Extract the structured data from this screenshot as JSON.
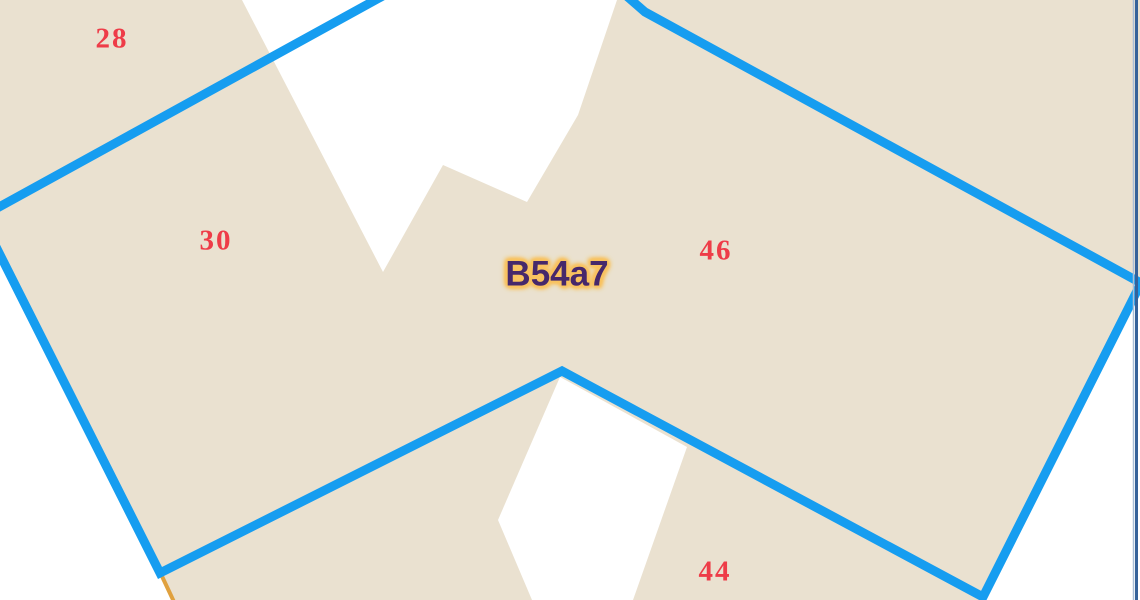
{
  "map": {
    "region_label": {
      "text": "B54a7",
      "x": 557,
      "y": 274,
      "color": "#46286b",
      "glow_color": "#f9c360"
    },
    "parcel_numbers": [
      {
        "text": "28",
        "x": 112,
        "y": 39
      },
      {
        "text": "30",
        "x": 216,
        "y": 241
      },
      {
        "text": "46",
        "x": 716,
        "y": 251
      },
      {
        "text": "44",
        "x": 715,
        "y": 572
      }
    ],
    "colors": {
      "background": "#ffffff",
      "parcel_fill": "#eae1d0",
      "boundary": "#169df0",
      "parcel_number": "#ee3c48",
      "survey_line": "#e0a13e",
      "edge_line": "#35629a",
      "edge_line_light": "#a9bfd8"
    }
  }
}
